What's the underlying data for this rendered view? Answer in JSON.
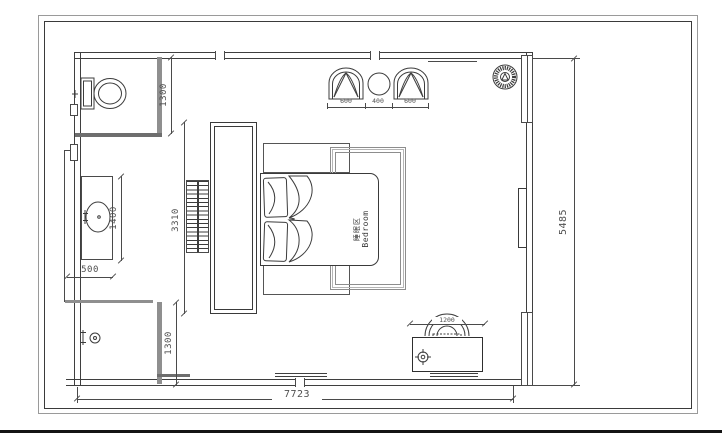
{
  "labels": {
    "cn": "睡眠区",
    "en": "Bedroom"
  },
  "dims": {
    "bath": "1300",
    "vanity_len": "1400",
    "vanity_w": "500",
    "feature_wall": "3310",
    "shower": "1300",
    "seat_l": "600",
    "seat_c": "400",
    "seat_r": "600",
    "desk": "1200",
    "total_h": "5485",
    "total_w": "7723"
  },
  "colors": {
    "line": "#4a4a4a",
    "wall_gray": "#8f8f8f",
    "background": "#ffffff"
  }
}
